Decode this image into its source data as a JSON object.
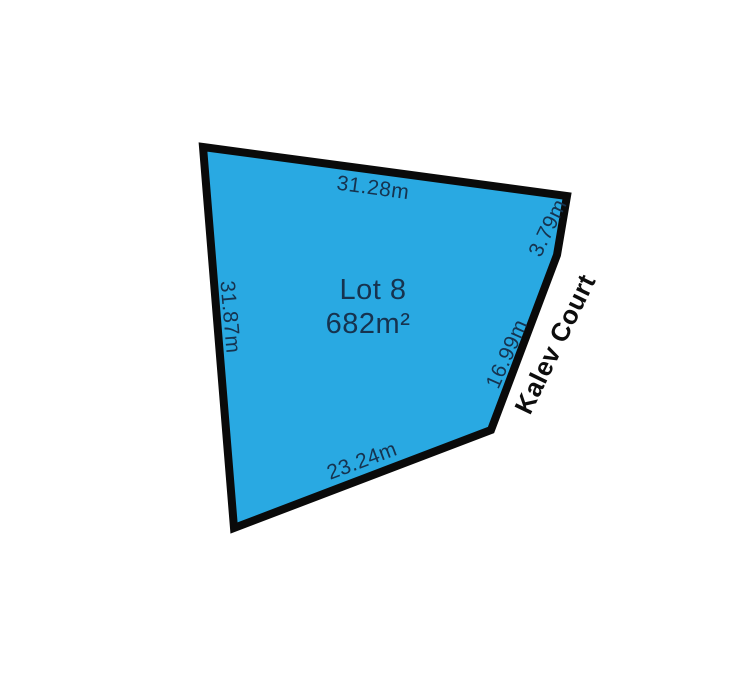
{
  "diagram": {
    "lot": {
      "name": "Lot 8",
      "area": "682m²"
    },
    "street": {
      "name": "Kalev Court"
    },
    "dimensions": {
      "top": "31.28m",
      "top_right": "3.79m",
      "right": "16.99m",
      "bottom": "23.24m",
      "left": "31.87m"
    },
    "colors": {
      "background": "#ffffff",
      "lot_fill": "#29A9E2",
      "boundary_stroke": "#0a0a0a",
      "dimension_text": "#16334F",
      "street_text": "#0d0d0d"
    }
  }
}
